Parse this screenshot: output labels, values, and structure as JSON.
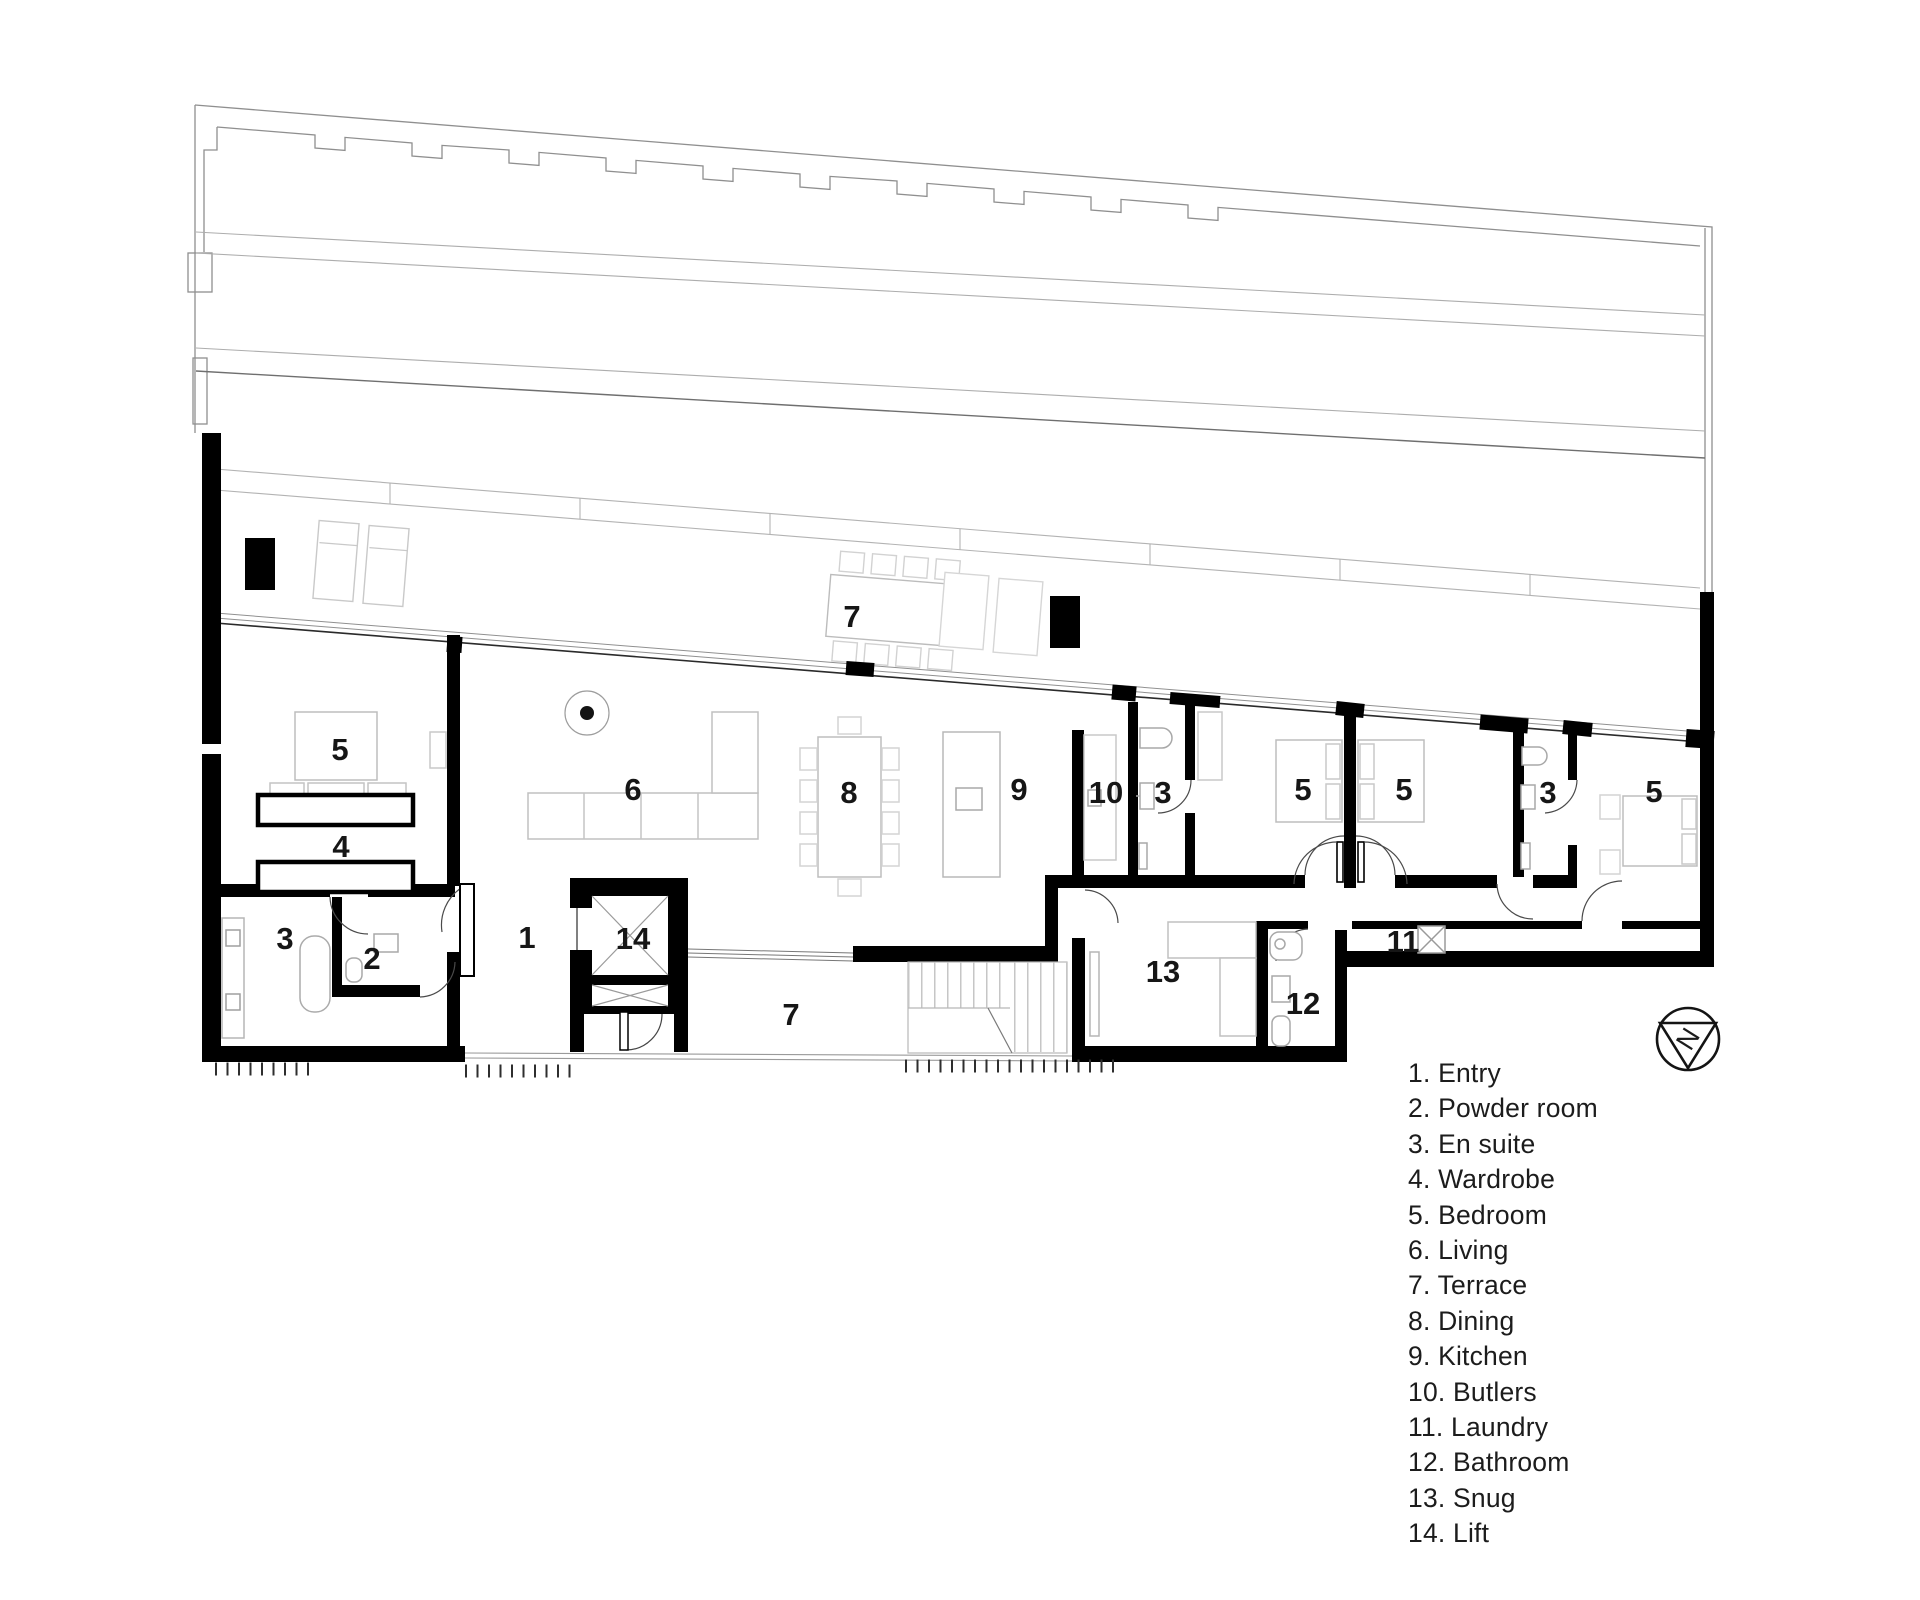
{
  "plan": {
    "labels": [
      {
        "room": "terrace-upper",
        "text": "7"
      },
      {
        "room": "bedroom-left",
        "text": "5"
      },
      {
        "room": "wardrobe",
        "text": "4"
      },
      {
        "room": "ensuite-left",
        "text": "3"
      },
      {
        "room": "powder-room",
        "text": "2"
      },
      {
        "room": "entry",
        "text": "1"
      },
      {
        "room": "lift",
        "text": "14"
      },
      {
        "room": "living",
        "text": "6"
      },
      {
        "room": "dining",
        "text": "8"
      },
      {
        "room": "kitchen",
        "text": "9"
      },
      {
        "room": "butlers",
        "text": "10"
      },
      {
        "room": "ensuite-mid",
        "text": "3"
      },
      {
        "room": "bedroom-mid-1",
        "text": "5"
      },
      {
        "room": "bedroom-mid-2",
        "text": "5"
      },
      {
        "room": "ensuite-right",
        "text": "3"
      },
      {
        "room": "bedroom-right",
        "text": "5"
      },
      {
        "room": "snug",
        "text": "13"
      },
      {
        "room": "bathroom",
        "text": "12"
      },
      {
        "room": "laundry",
        "text": "11"
      },
      {
        "room": "terrace-lower",
        "text": "7"
      }
    ],
    "north_label": "N",
    "wall_color": "#000000",
    "site_line_color": "#9a9a9a",
    "furniture_line_color": "#c4c4c4"
  },
  "legend": {
    "items": [
      "1. Entry",
      "2. Powder room",
      "3. En suite",
      "4. Wardrobe",
      "5. Bedroom",
      "6. Living",
      "7. Terrace",
      "8. Dining",
      "9. Kitchen",
      "10. Butlers",
      "11. Laundry",
      "12. Bathroom",
      "13. Snug",
      "14. Lift"
    ]
  }
}
